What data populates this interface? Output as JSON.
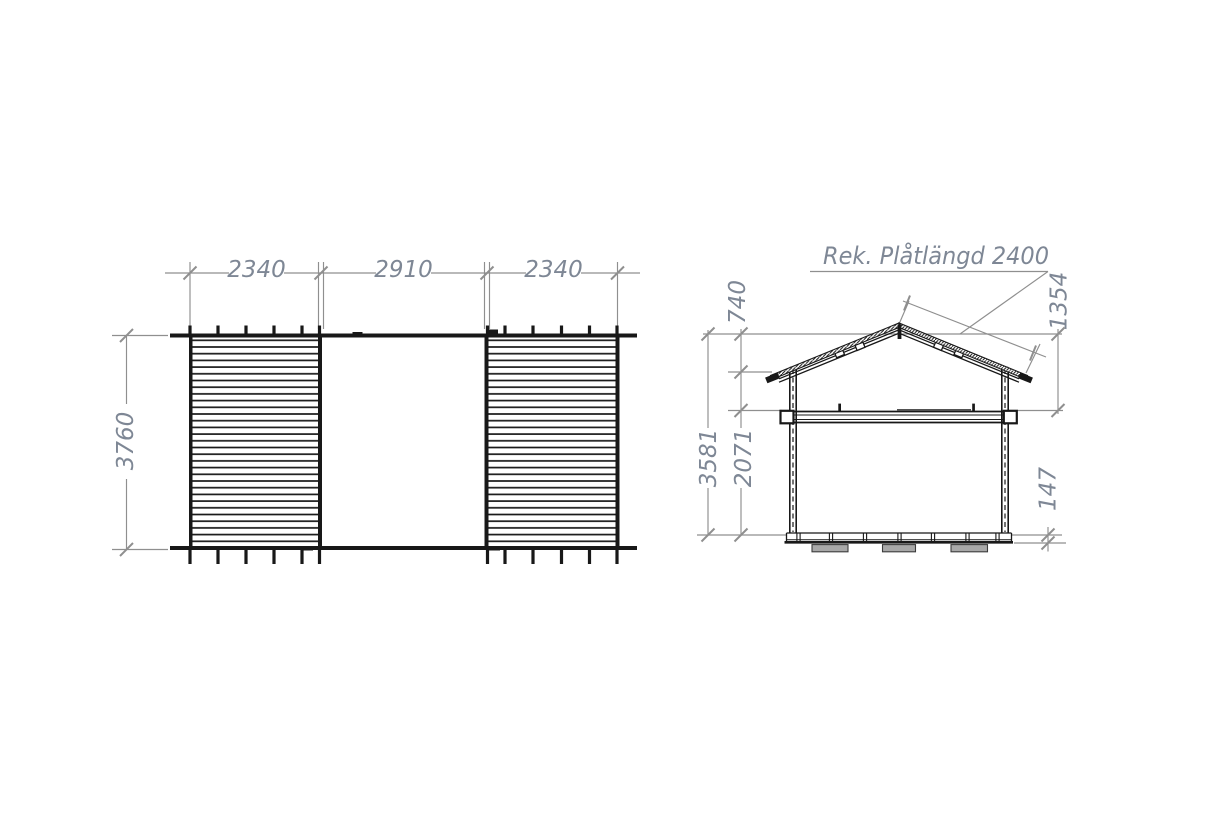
{
  "plan": {
    "dim_width_left": "2340",
    "dim_width_middle": "2910",
    "dim_width_right": "2340",
    "dim_depth": "3760"
  },
  "section": {
    "title": "Rek. Plåtlängd 2400",
    "dim_ridge_to_eave": "740",
    "dim_sheet_drop": "1354",
    "dim_total_height": "3581",
    "dim_wall_height": "2071",
    "dim_foundation_height": "147"
  },
  "colors": {
    "background": "#ffffff",
    "building_line": "#181818",
    "dimension_line": "#8f8f8f",
    "dimension_text": "#7e8795",
    "foundation_pad_fill": "#a8a8a8"
  }
}
